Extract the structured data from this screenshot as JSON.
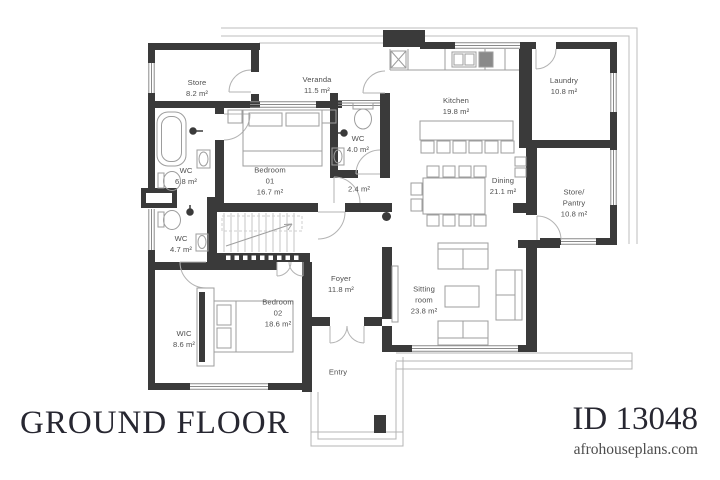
{
  "plan": {
    "title": "GROUND FLOOR",
    "plan_id": "ID 13048",
    "website": "afrohouseplans.com"
  },
  "colors": {
    "wall": "#3a3a3a",
    "furniture_line": "#9d9d9d",
    "label_text": "#4f4f4f",
    "footer_text": "#272731"
  },
  "rooms": [
    {
      "name": "Store",
      "area": "8.2 m²"
    },
    {
      "name": "Veranda",
      "area": "11.5 m²"
    },
    {
      "name": "Kitchen",
      "area": "19.8 m²"
    },
    {
      "name": "Laundry",
      "area": "10.8 m²"
    },
    {
      "name": "WC",
      "area": "6.8 m²"
    },
    {
      "name": "Bedroom\n01",
      "area": "16.7 m²"
    },
    {
      "name": "WC",
      "area": "4.0 m²"
    },
    {
      "name": "",
      "area": "2.4 m²"
    },
    {
      "name": "Dining",
      "area": "21.1 m²"
    },
    {
      "name": "Store/\nPantry",
      "area": "10.8 m²"
    },
    {
      "name": "WC",
      "area": "4.7 m²"
    },
    {
      "name": "Foyer",
      "area": "11.8 m²"
    },
    {
      "name": "WIC",
      "area": "8.6 m²"
    },
    {
      "name": "Bedroom\n02",
      "area": "18.6 m²"
    },
    {
      "name": "Entry",
      "area": ""
    },
    {
      "name": "Sitting\nroom",
      "area": "23.8 m²"
    }
  ]
}
